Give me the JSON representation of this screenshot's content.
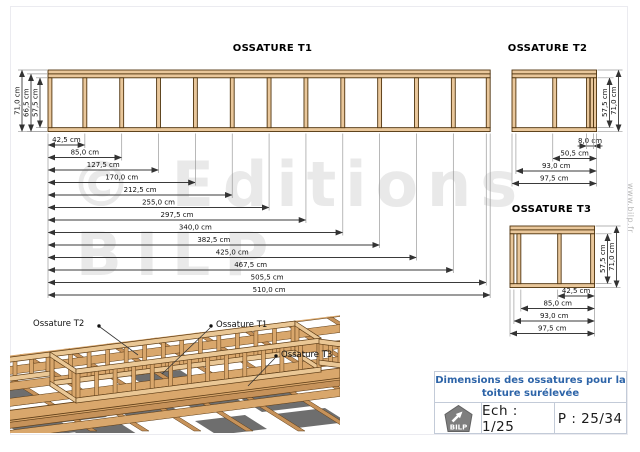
{
  "page": {
    "watermark_line1": "© Editions",
    "watermark_line2": "BILP",
    "side_text": "www.bilp.fr"
  },
  "frames": {
    "t1": {
      "title": "OSSATURE T1",
      "length_cm": 510,
      "studs_cm": [
        [
          0,
          4.5
        ],
        [
          40.25,
          44.75
        ],
        [
          82.75,
          87.25
        ],
        [
          125.25,
          129.75
        ],
        [
          167.75,
          172.25
        ],
        [
          210.25,
          214.75
        ],
        [
          252.75,
          257.25
        ],
        [
          295.25,
          299.75
        ],
        [
          337.75,
          342.25
        ],
        [
          380.25,
          384.75
        ],
        [
          422.75,
          427.25
        ],
        [
          465.25,
          469.75
        ],
        [
          505.5,
          510
        ]
      ],
      "length_dims": [
        {
          "label": "42,5 cm",
          "from_cm": 0,
          "to_cm": 42.5
        },
        {
          "label": "85,0 cm",
          "from_cm": 0,
          "to_cm": 85
        },
        {
          "label": "127,5 cm",
          "from_cm": 0,
          "to_cm": 127.5
        },
        {
          "label": "170,0 cm",
          "from_cm": 0,
          "to_cm": 170
        },
        {
          "label": "212,5 cm",
          "from_cm": 0,
          "to_cm": 212.5
        },
        {
          "label": "255,0 cm",
          "from_cm": 0,
          "to_cm": 255
        },
        {
          "label": "297,5 cm",
          "from_cm": 0,
          "to_cm": 297.5
        },
        {
          "label": "340,0 cm",
          "from_cm": 0,
          "to_cm": 340
        },
        {
          "label": "382,5 cm",
          "from_cm": 0,
          "to_cm": 382.5
        },
        {
          "label": "425,0 cm",
          "from_cm": 0,
          "to_cm": 425
        },
        {
          "label": "467,5 cm",
          "from_cm": 0,
          "to_cm": 467.5
        },
        {
          "label": "505,5 cm",
          "from_cm": 0,
          "to_cm": 505.5
        },
        {
          "label": "510,0 cm",
          "from_cm": 0,
          "to_cm": 510
        }
      ],
      "height_dims": [
        {
          "label": "71,0 cm",
          "from_cm": 0,
          "to_cm": 71
        },
        {
          "label": "66,5 cm",
          "from_cm": 4.5,
          "to_cm": 71
        },
        {
          "label": "57,5 cm",
          "from_cm": 9,
          "to_cm": 66.5
        }
      ]
    },
    "t2": {
      "title": "OSSATURE T2",
      "length_cm": 97.5,
      "studs_cm": [
        [
          0,
          4.5
        ],
        [
          47,
          51.5
        ],
        [
          86,
          89.75
        ],
        [
          90.25,
          94
        ],
        [
          94,
          97.5
        ]
      ],
      "length_dims": [
        {
          "label": "8,0 cm",
          "from_cm": 86,
          "to_cm": 94
        },
        {
          "label": "50,5 cm",
          "from_cm": 47,
          "to_cm": 97.5
        },
        {
          "label": "93,0 cm",
          "from_cm": 4.5,
          "to_cm": 97.5
        },
        {
          "label": "97,5 cm",
          "from_cm": 0,
          "to_cm": 97.5
        }
      ],
      "height_dims": [
        {
          "label": "57,5 cm",
          "from_cm": 9,
          "to_cm": 66.5
        },
        {
          "label": "71,0 cm",
          "from_cm": 0,
          "to_cm": 71
        }
      ]
    },
    "t3": {
      "title": "OSSATURE T3",
      "length_cm": 97.5,
      "studs_cm": [
        [
          0,
          4.5
        ],
        [
          8,
          12.5
        ],
        [
          55,
          59
        ],
        [
          93,
          97.5
        ]
      ],
      "length_dims": [
        {
          "label": "42,5 cm",
          "from_cm": 55,
          "to_cm": 97.5
        },
        {
          "label": "85,0 cm",
          "from_cm": 12.5,
          "to_cm": 97.5
        },
        {
          "label": "93,0 cm",
          "from_cm": 4.5,
          "to_cm": 97.5
        },
        {
          "label": "97,5 cm",
          "from_cm": 0,
          "to_cm": 97.5
        }
      ],
      "height_dims": [
        {
          "label": "57,5 cm",
          "from_cm": 9,
          "to_cm": 66.5
        },
        {
          "label": "71,0 cm",
          "from_cm": 0,
          "to_cm": 71
        }
      ]
    }
  },
  "iso_labels": [
    {
      "text": "Ossature T2"
    },
    {
      "text": "Ossature T1"
    },
    {
      "text": "Ossature T3"
    }
  ],
  "title_block": {
    "title_line1": "Dimensions des ossatures pour la",
    "title_line2": "toiture surélevée",
    "logo_text": "BILP",
    "scale_label": "Ech : 1/25",
    "page_label": "P : 25/34"
  },
  "colors": {
    "wood": "#e9c79b",
    "wood_outline": "#50340e",
    "iso_wood": "#d9a76c",
    "iso_wood_light": "#eac795",
    "iso_panel": "#6e6e6e",
    "title_blue": "#2d64a8",
    "watermark_gray": "#e9e9e9"
  }
}
